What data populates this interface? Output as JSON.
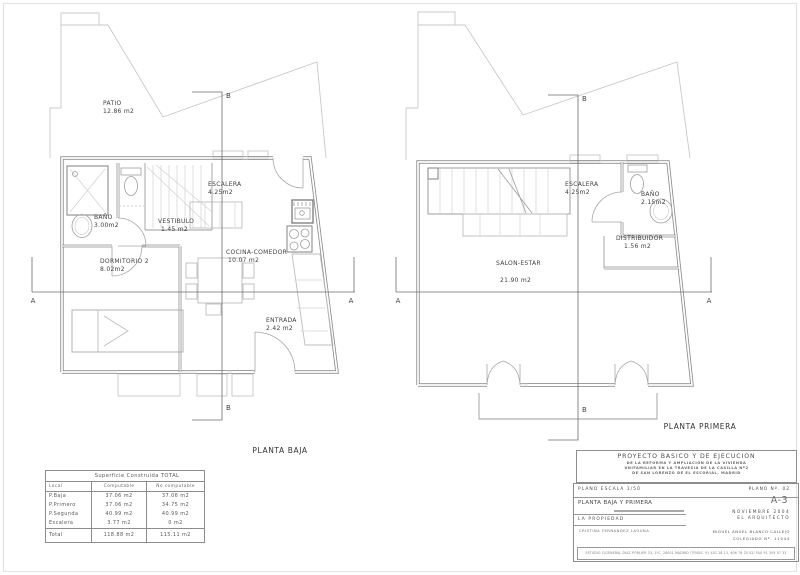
{
  "sheet": {
    "plans": [
      {
        "title": "PLANTA BAJA",
        "rooms": [
          {
            "name": "PATIO",
            "area": "12.86 m2"
          },
          {
            "name": "ESCALERA",
            "area": "4.25m2"
          },
          {
            "name": "BAÑO",
            "area": "3.00m2"
          },
          {
            "name": "VESTIBULO",
            "area": "1.45 m2"
          },
          {
            "name": "DORMITORIO 2",
            "area": "8.02m2"
          },
          {
            "name": "COCINA-COMEDOR",
            "area": "10.07 m2"
          },
          {
            "name": "ENTRADA",
            "area": "2.42 m2"
          }
        ]
      },
      {
        "title": "PLANTA PRIMERA",
        "rooms": [
          {
            "name": "ESCALERA",
            "area": "4.25m2"
          },
          {
            "name": "BAÑO",
            "area": "2.15m2"
          },
          {
            "name": "DISTRIBUIDOR",
            "area": "1.56 m2"
          },
          {
            "name": "SALON-ESTAR",
            "area": "21.90 m2"
          }
        ]
      }
    ],
    "section_markers": {
      "a": "A",
      "b": "B"
    },
    "areas_table": {
      "title": "Superficie Construida TOTAL",
      "headers": [
        "Local",
        "Computable",
        "No computable"
      ],
      "rows": [
        {
          "local": "P.Baja",
          "computable": "37.06 m2",
          "no_computable": "37.06 m2"
        },
        {
          "local": "P.Primero",
          "computable": "37.06 m2",
          "no_computable": "34.75 m2"
        },
        {
          "local": "P.Segunda",
          "computable": "40.99 m2",
          "no_computable": "40.99 m2"
        },
        {
          "local": "Escalera",
          "computable": "3.77 m2",
          "no_computable": "0 m2"
        }
      ],
      "total": {
        "local": "Total",
        "computable": "118.88 m2",
        "no_computable": "115.11 m2"
      }
    },
    "title_block": {
      "project_title": "PROYECTO BASICO Y DE EJECUCION",
      "project_line2": "DE LA REFORMA Y AMPLIACIÓN DE LA VIVIENDA",
      "project_line3": "UNIFAMILIAR EN LA TRAVESIA DE LA CASILLA Nº2",
      "project_line4": "DE SAN LORENZO DE EL ESCORIAL, MADRID",
      "scale_label": "PLANO ESCALA 1/50",
      "plano_num": "PLANO Nº. 02",
      "plan_name": "PLANTA BAJA Y PRIMERA",
      "sheet_code": "A-3",
      "date": "NOVIEMBRE 2004",
      "owner_label": "LA PROPIEDAD",
      "architect_label": "EL ARQUITECTO",
      "owner_name": "CRISTINA FERNANDEZ LAGUNA",
      "architect_name": "MIGUEL ANGEL BLANCO CALLEJO",
      "colegiado": "COLEGIADO Nº. 11044",
      "address": "ESTUDIO C/GENERAL DIAZ PORLIER 33, 1ºC, 28001 MADRID /TFNOS. 91 402 28 13, 606 76 25 52/ FAX 91 309 57 33"
    },
    "colors": {
      "wall": "#8d8d8d",
      "light_line": "#c9c9c9",
      "text": "#3f3f3f"
    }
  }
}
